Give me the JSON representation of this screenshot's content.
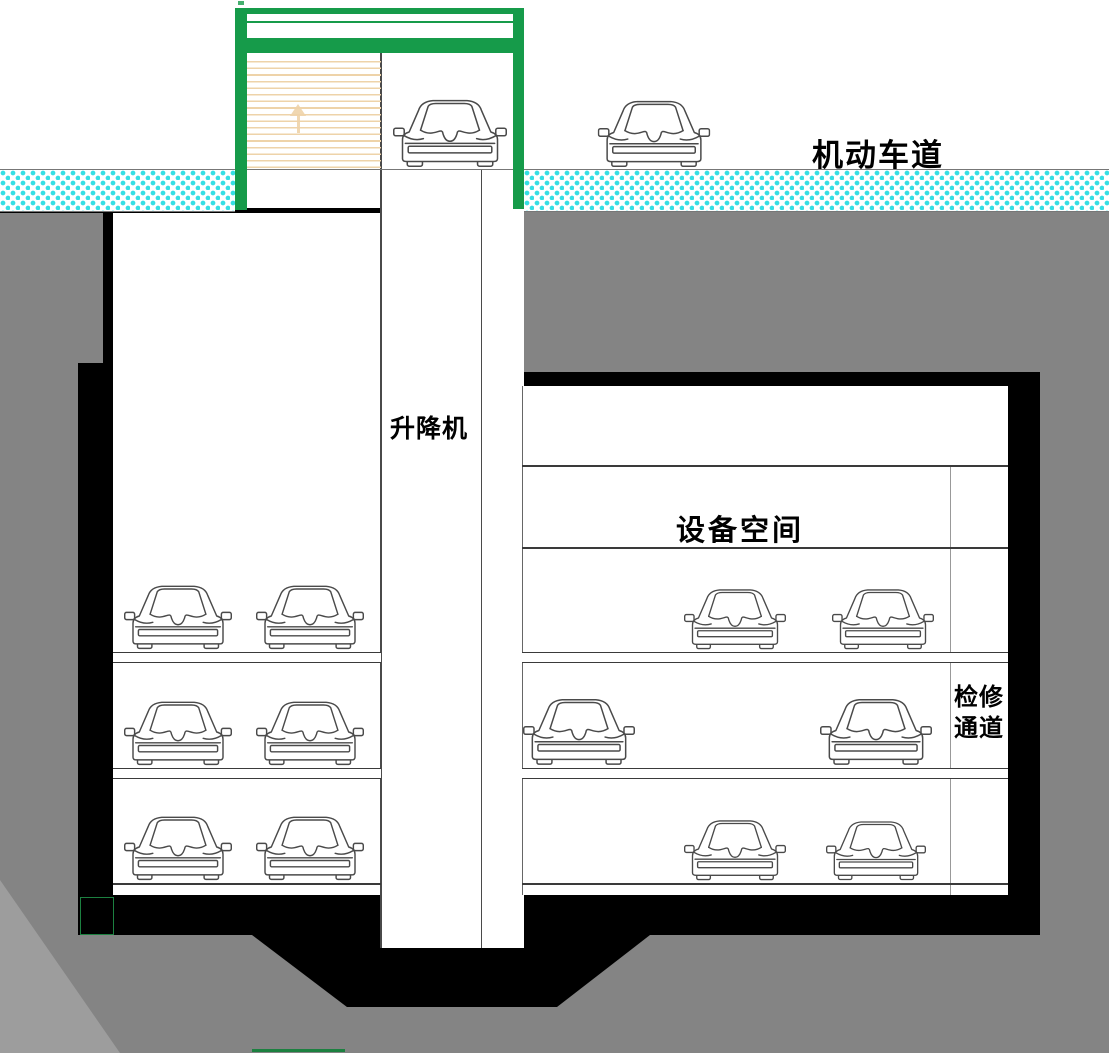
{
  "labels": {
    "road": "机动车道",
    "lift": "升降机",
    "equipment": "设备空间",
    "maintenance_line1": "检修",
    "maintenance_line2": "通道"
  },
  "colors": {
    "frame_green": "#169b4a",
    "road_hatch_cyan": "#35dfe4",
    "earth_gray": "#848484",
    "earth_gray_light": "#9d9d9d",
    "structure_black": "#000000",
    "door_tan": "#eed3a9",
    "line_gray": "#4a4a4a"
  },
  "icons": {
    "car": "car-front-icon",
    "door": "roller-door",
    "arrow": "arrow-up-icon"
  },
  "diagram": {
    "type": "section-drawing",
    "description_levels": [
      "surface road level",
      "upper void",
      "equipment level",
      "parking level 1",
      "parking level 2",
      "parking level 3"
    ],
    "cars": [
      {
        "group": "surface-entrance",
        "x": 392,
        "y": 94,
        "w": 116,
        "h": 76
      },
      {
        "group": "surface-road",
        "x": 597,
        "y": 95,
        "w": 114,
        "h": 75
      },
      {
        "group": "left-level1",
        "x": 124,
        "y": 580,
        "w": 108,
        "h": 72
      },
      {
        "group": "left-level1",
        "x": 256,
        "y": 580,
        "w": 108,
        "h": 72
      },
      {
        "group": "left-level2",
        "x": 124,
        "y": 696,
        "w": 108,
        "h": 72
      },
      {
        "group": "left-level2",
        "x": 256,
        "y": 696,
        "w": 108,
        "h": 72
      },
      {
        "group": "left-level3",
        "x": 124,
        "y": 811,
        "w": 108,
        "h": 72
      },
      {
        "group": "left-level3",
        "x": 256,
        "y": 811,
        "w": 108,
        "h": 72
      },
      {
        "group": "right-level1",
        "x": 684,
        "y": 584,
        "w": 102,
        "h": 68
      },
      {
        "group": "right-level1",
        "x": 832,
        "y": 584,
        "w": 102,
        "h": 68
      },
      {
        "group": "right-level2",
        "x": 523,
        "y": 693,
        "w": 112,
        "h": 75
      },
      {
        "group": "right-level2",
        "x": 820,
        "y": 693,
        "w": 112,
        "h": 75
      },
      {
        "group": "right-level3",
        "x": 684,
        "y": 815,
        "w": 102,
        "h": 68
      },
      {
        "group": "right-level3",
        "x": 826,
        "y": 816,
        "w": 100,
        "h": 67
      }
    ]
  }
}
